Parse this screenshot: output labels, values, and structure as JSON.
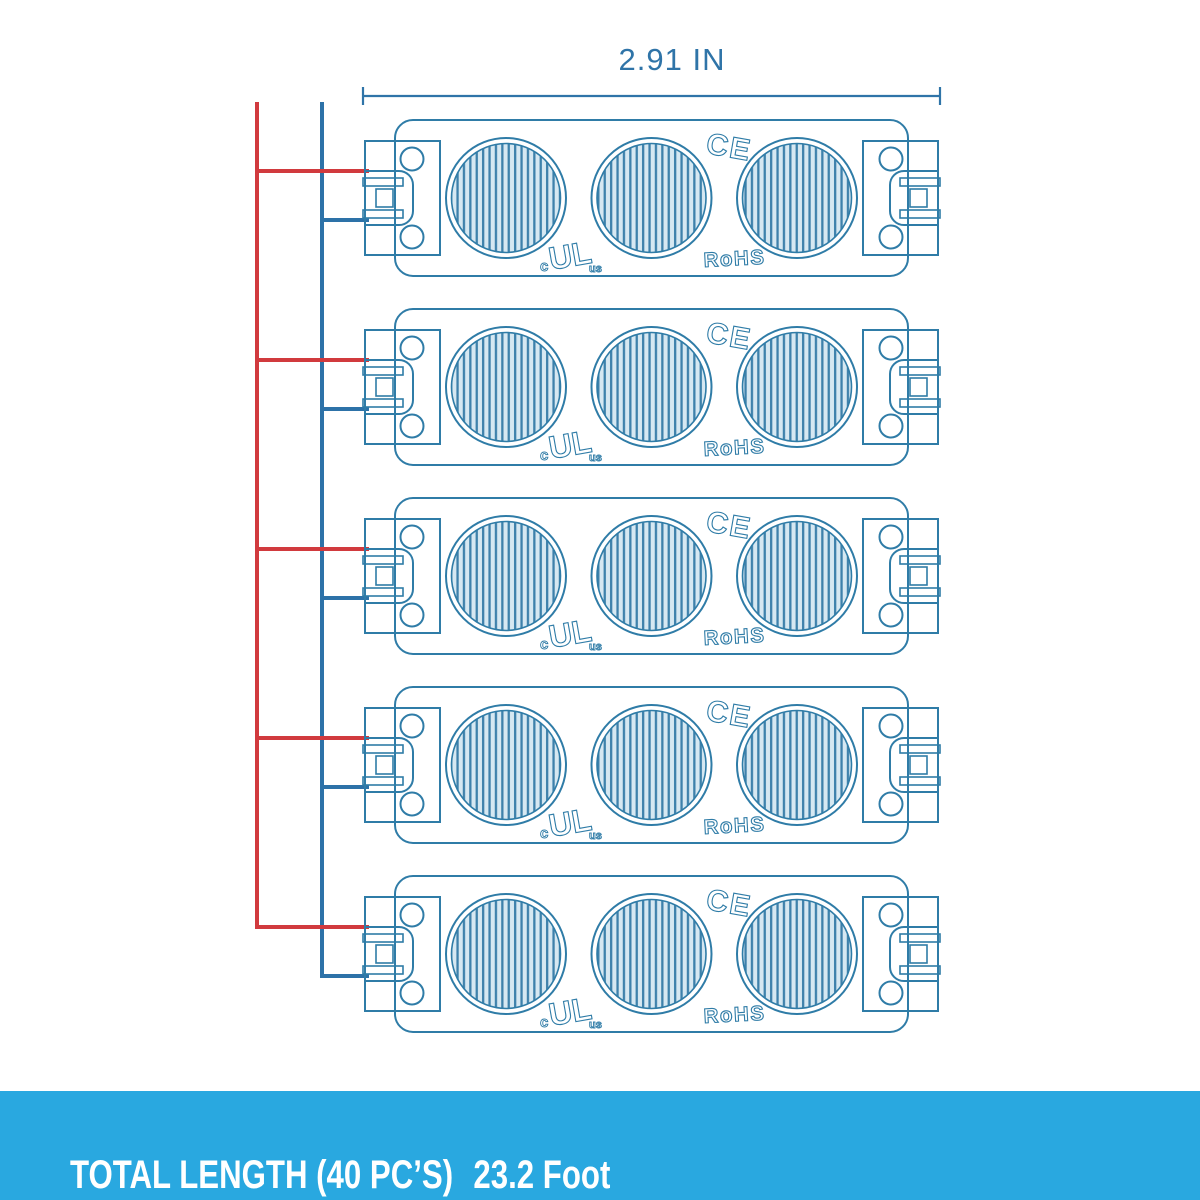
{
  "dimension": {
    "width_label": "2.91 IN"
  },
  "modules": {
    "count": 5,
    "leds_per_module": 3,
    "marks": {
      "ce": "CE",
      "ul_prefix": "c",
      "ul": "UL",
      "ul_suffix": "us",
      "rohs": "RoHS"
    }
  },
  "wiring": {
    "positive_wire_color_name": "red",
    "negative_wire_color_name": "blue"
  },
  "footer": {
    "total_length_label": "TOTAL LENGTH (40 PC’S)",
    "total_length_value": "23.2 Foot"
  },
  "colors": {
    "outline": "#2f7ca7",
    "wire_red": "#d13a3e",
    "wire_blue": "#2d72a8",
    "led_fill": "#d6e8f2",
    "led_stripe": "#3e81ab",
    "dimension": "#2f74a8",
    "footer_bg": "#29a8e0",
    "footer_text": "#ffffff"
  }
}
